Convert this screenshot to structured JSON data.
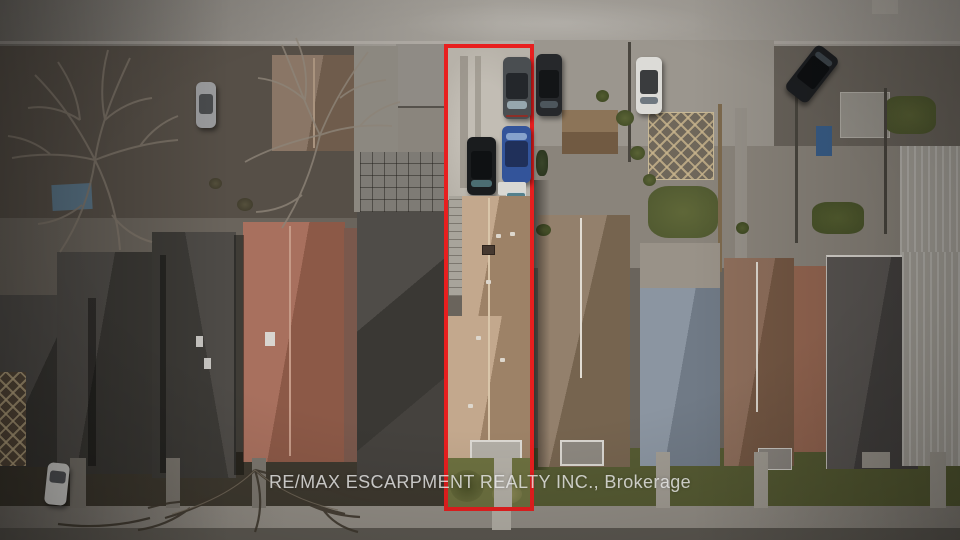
{
  "watermark": {
    "text": "RE/MAX ESCARPMENT REALTY INC., Brokerage"
  },
  "scene": {
    "type": "aerial-drone-photo",
    "subject": "narrow residential lot outlined in red with tan-roof house, rear parking pad and front lawn",
    "vehicles": [
      {
        "name": "grey-suv",
        "location": "subject rear pad, top right",
        "color": "#4a4e51"
      },
      {
        "name": "blue-suv",
        "location": "subject rear pad, right",
        "color": "#33549a"
      },
      {
        "name": "black-suv",
        "location": "subject rear pad, left",
        "color": "#1a1c1e"
      },
      {
        "name": "dark-car",
        "location": "right of subject lot on rear lane",
        "color": "#26282b"
      },
      {
        "name": "white-car",
        "location": "rear parking, right side",
        "color": "#dcdbd7"
      },
      {
        "name": "black-suv-diagonal",
        "location": "far right rear lane",
        "color": "#1d1f22"
      },
      {
        "name": "silver-car",
        "location": "top left backyard",
        "color": "#9b9c9e"
      },
      {
        "name": "white-car-driveway",
        "location": "bottom left front driveway",
        "color": "#d6d5d1"
      }
    ]
  },
  "colors": {
    "outline_red": "#e81f1f",
    "road_top": "#9d9891",
    "road_top_dark": "#6f6b65",
    "road_bottom": "#5d5952",
    "sidewalk": "#938e86",
    "ground_left": "#564f47",
    "ground_right": "#8a847b",
    "frontyard_left": "#3e392f",
    "frontyard_right": "#565b33",
    "pad_concrete": "#b7b2a9",
    "charcoal_light": "#514e4a",
    "charcoal_dark": "#3a3834",
    "salmon_light": "#a8705e",
    "salmon_dark": "#8c5947",
    "subject_roof_light": "#c3a88d",
    "subject_roof_dark": "#9d8267",
    "subject_ridge": "#d9c6aa",
    "lawn": "#6d7140",
    "lawn_dark": "#4c5128",
    "lawn_dry": "#8f8b58",
    "walkway": "#b4b0a7",
    "brown_roof_light": "#93806c",
    "brown_roof_dark": "#76644f",
    "bluegray_light": "#8b95a1",
    "bluegray_dark": "#707a86",
    "redbrown_light": "#8f6f5c",
    "redbrown_dark": "#755844",
    "darkgray_light": "#5b5754",
    "darkgray_dark": "#454240",
    "corrugated": "#a9a59d",
    "garage_brown_light": "#8a7666",
    "garage_brown_dark": "#6f5c4c",
    "tarp_blue": "#5a7486",
    "watermark_color": "rgba(240,240,240,0.78)"
  }
}
